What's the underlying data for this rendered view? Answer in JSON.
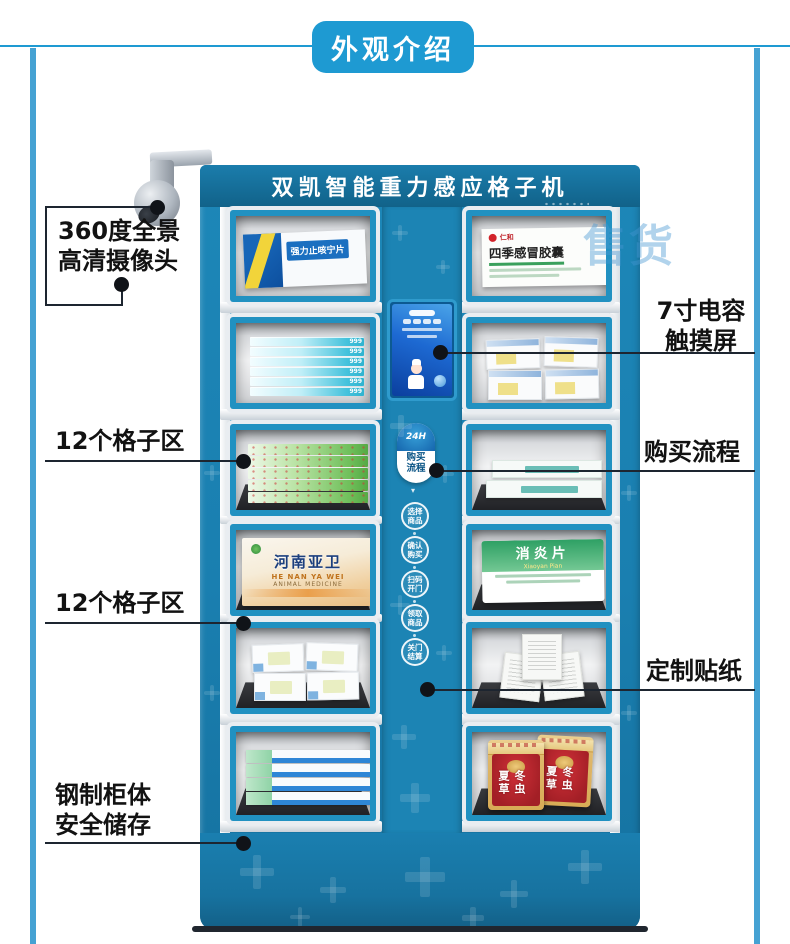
{
  "banner": {
    "title": "外观介绍"
  },
  "machine": {
    "header_title": "双凯智能重力感应格子机",
    "flow_badge": {
      "logo": "24H",
      "line1": "购买",
      "line2": "流程"
    },
    "steps": [
      {
        "line1": "选择",
        "line2": "商品"
      },
      {
        "line1": "确认",
        "line2": "购买"
      },
      {
        "line1": "扫码",
        "line2": "开门"
      },
      {
        "line1": "领取",
        "line2": "商品"
      },
      {
        "line1": "关门",
        "line2": "结算"
      }
    ]
  },
  "products": {
    "r1_left_name": "强力止咳宁片",
    "r1_right_brand": "仁和",
    "r1_right_name": "四季感冒胶囊",
    "r2_left_brand": "999",
    "r4_left_name": "河南亚卫",
    "r4_left_sub": "HE NAN YA WEI",
    "r4_left_sub2": "ANIMAL MEDICINE",
    "r4_right_name": "消炎片",
    "r4_right_sub": "Xiaoyan Pian",
    "r6_right_name": "冬虫夏草"
  },
  "callouts": {
    "camera": {
      "line1": "360度全景",
      "line2": "高清摄像头"
    },
    "grid_top": "12个格子区",
    "grid_bottom": "12个格子区",
    "cabinet": {
      "line1": "钢制柜体",
      "line2": "安全储存"
    },
    "touchscreen": {
      "line1": "7寸电容",
      "line2": "触摸屏"
    },
    "flow": "购买流程",
    "sticker": "定制贴纸"
  },
  "watermark": "售货",
  "colors": {
    "accent_blue": "#1e9ad2",
    "machine_blue": "#1a7fb0",
    "frame_blue": "#2191c1",
    "callout_line": "#1d2530"
  }
}
